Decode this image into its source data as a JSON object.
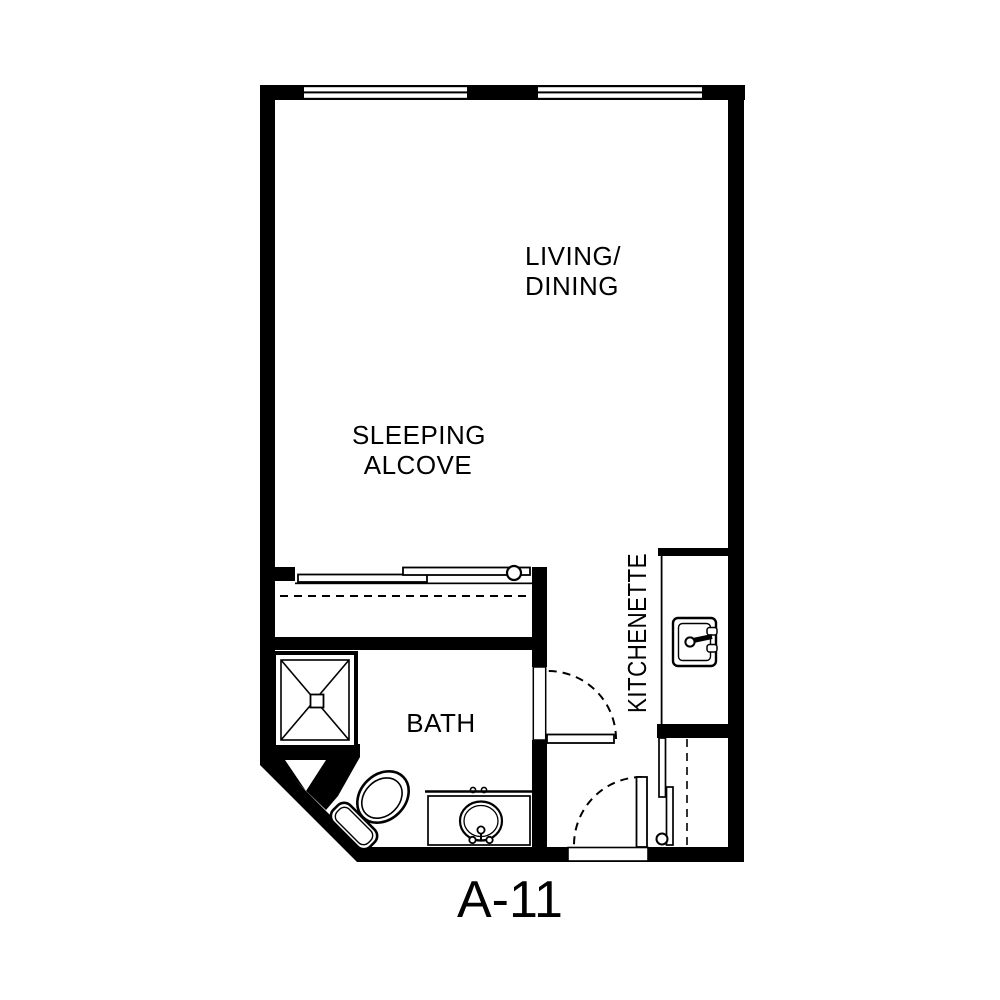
{
  "plan": {
    "unit_label": "A-11",
    "labels": {
      "living_line1": "LIVING/",
      "living_line2": "DINING",
      "sleeping_line1": "SLEEPING",
      "sleeping_line2": "ALCOVE",
      "bath": "BATH",
      "kitchenette": "KITCHENETTE"
    },
    "colors": {
      "wall": "#000000",
      "floor": "#ffffff"
    },
    "fixtures": [
      "window",
      "window",
      "bypass-closet-doors",
      "corner-shower",
      "toilet",
      "vanity-sink",
      "kitchen-sink",
      "hinged-door-bath",
      "hinged-door-entry",
      "entry-closet-bypass-doors"
    ]
  }
}
